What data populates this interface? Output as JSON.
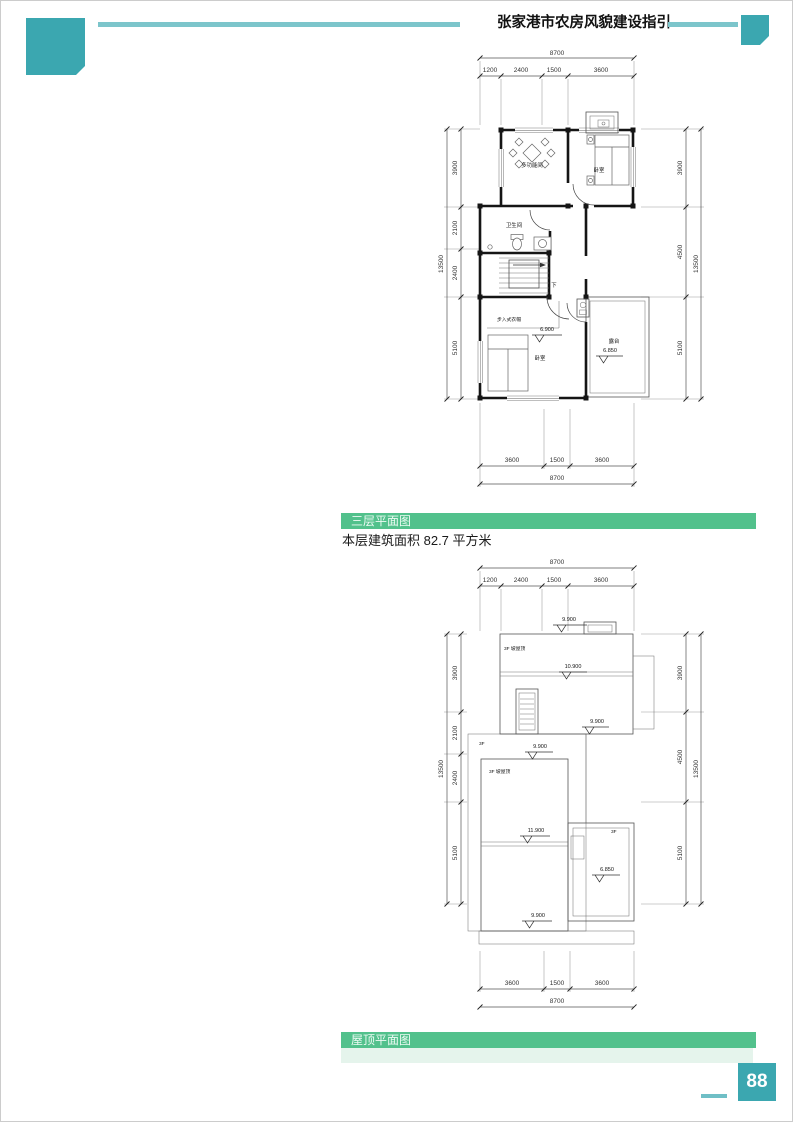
{
  "page": {
    "header_title": "张家港市农房风貌建设指引",
    "page_number": "88"
  },
  "sections": {
    "floor3_bar": "三层平面图",
    "floor3_area": "本层建筑面积 82.7 平方米",
    "roof_bar": "屋顶平面图"
  },
  "colors": {
    "teal": "#3BA7B0",
    "teal_light": "#7CC5CB",
    "green": "#52C18C",
    "green_pale": "#E5F4EC"
  },
  "plan1": {
    "dims": {
      "top_total": "8700",
      "top": [
        "1200",
        "2400",
        "1500",
        "3600"
      ],
      "bottom": [
        "3600",
        "1500",
        "3600"
      ],
      "bottom_total": "8700",
      "left": [
        "3900",
        "2100",
        "2400",
        "5100"
      ],
      "left_total": "13500",
      "right": [
        "3900",
        "4500",
        "5100"
      ],
      "right_total": "13500"
    },
    "rooms": {
      "multi": "多功能间",
      "bedroom_top": "卧室",
      "bath": "卫生间",
      "stair_down": "下",
      "closet": "步入式衣帽",
      "bedroom_bottom": "卧室",
      "terrace": "露台"
    },
    "levels": {
      "bedroom": "6.900",
      "terrace": "6.850"
    }
  },
  "plan2": {
    "dims": {
      "top_total": "8700",
      "top": [
        "1200",
        "2400",
        "1500",
        "3600"
      ],
      "bottom": [
        "3600",
        "1500",
        "3600"
      ],
      "bottom_total": "8700",
      "left": [
        "3900",
        "2100",
        "2400",
        "5100"
      ],
      "left_total": "13500",
      "right": [
        "3900",
        "4500",
        "5100"
      ],
      "right_total": "13500"
    },
    "labels": {
      "roof_upper": "3F 坡屋顶",
      "roof_lower": "3F 坡屋顶",
      "flat_left": "3F",
      "flat_right": "3F"
    },
    "levels": {
      "top": "9.900",
      "ridge_upper": "10.900",
      "mid_right": "9.900",
      "mid": "9.900",
      "ridge_lower": "11.900",
      "bottom": "9.900",
      "terrace": "6.850"
    }
  }
}
